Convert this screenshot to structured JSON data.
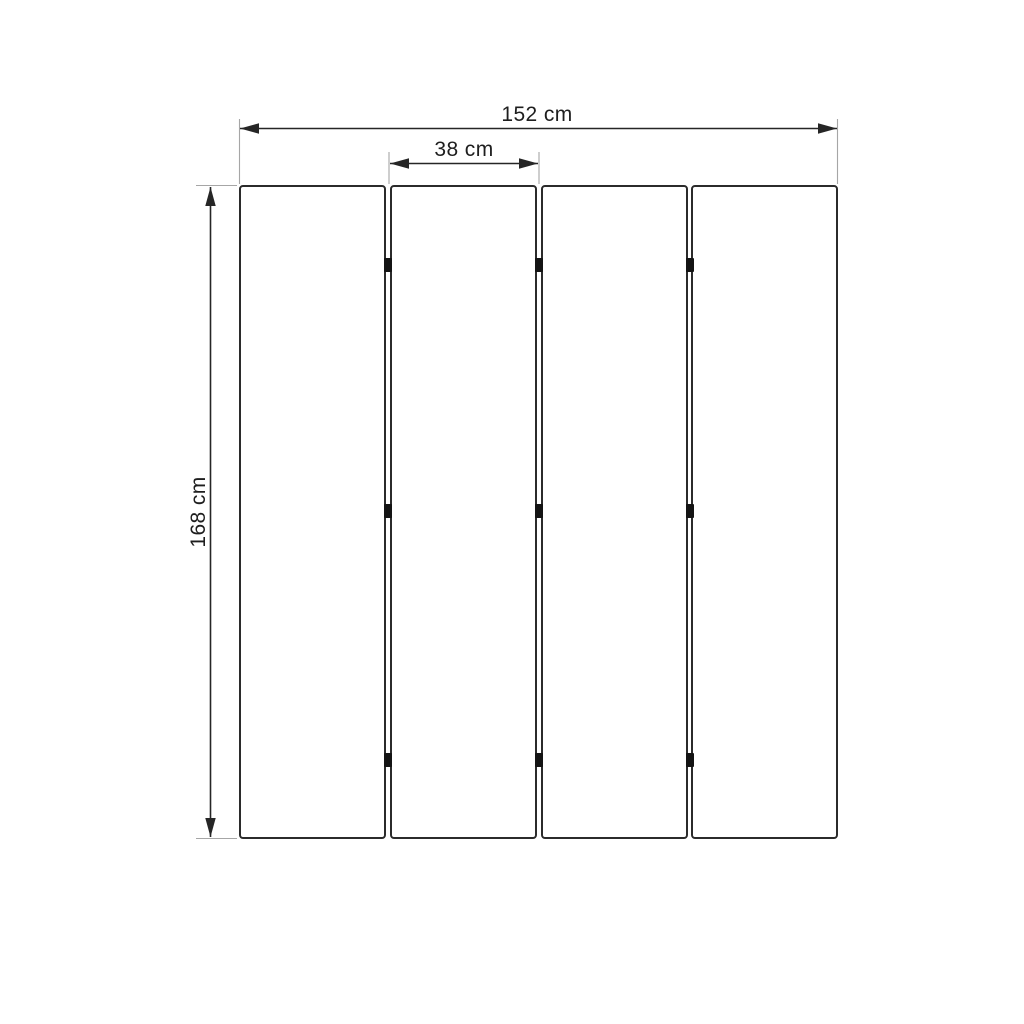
{
  "diagram": {
    "panel_count": 4,
    "dimensions": {
      "total_width": {
        "label": "152 cm"
      },
      "panel_width": {
        "label": "38 cm"
      },
      "height": {
        "label": "168 cm"
      }
    },
    "colors": {
      "background": "#ffffff",
      "panel_border": "#2b2b2b",
      "dimension_line": "#262626",
      "extension_line": "#a6a6a6",
      "hinge": "#141414",
      "text": "#1e1e1e"
    }
  }
}
